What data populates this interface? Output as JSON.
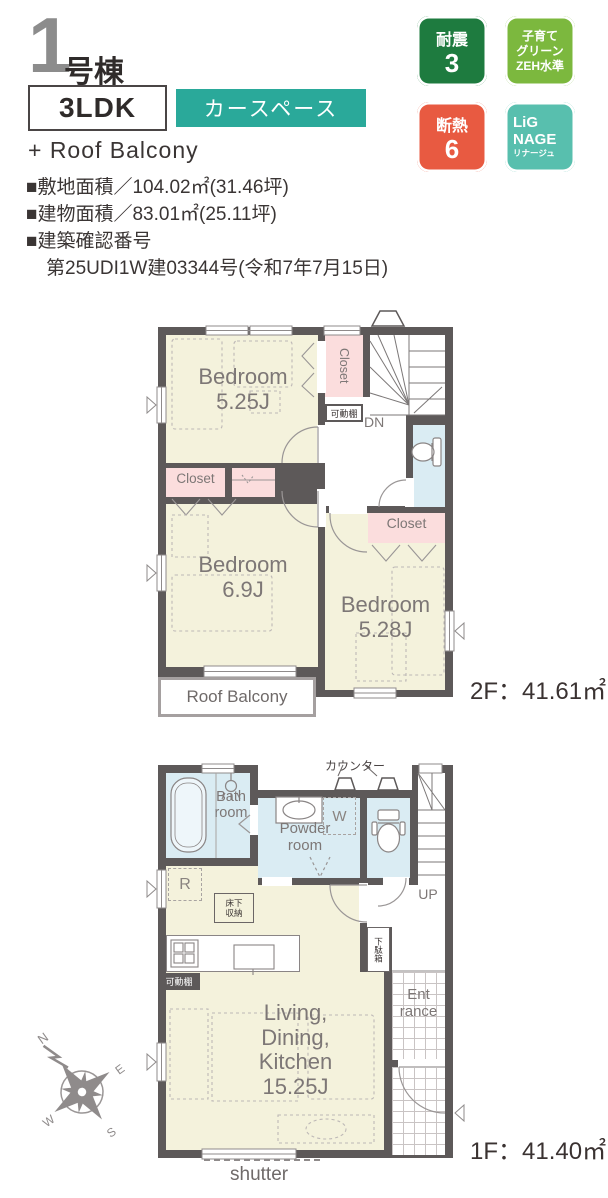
{
  "header": {
    "unit_number": "1",
    "unit_suffix": "号棟",
    "layout": "3LDK",
    "feature": "カースペース",
    "extra": "+ Roof Balcony"
  },
  "specs": {
    "site_area": "■敷地面積／104.02㎡(31.46坪)",
    "building_area": "■建物面積／83.01㎡(25.11坪)",
    "confirmation_title": "■建築確認番号",
    "confirmation_number": "第25UDI1W建03344号(令和7年7月15日)"
  },
  "badges": {
    "taishin_label": "耐震",
    "taishin_value": "3",
    "kosodate_lines": "子育て\nグリーン\nZEH水準",
    "dannetsu_label": "断熱",
    "dannetsu_value": "6",
    "lignage_line1": "LiG",
    "lignage_line2": "NAGE",
    "lignage_line3": "リナージュ"
  },
  "colors": {
    "taishin": "#1e7b3f",
    "kosodate": "#7cb83e",
    "dannetsu": "#e85a41",
    "lignage": "#58bfae",
    "feature_badge": "#2aa99a"
  },
  "floor2": {
    "area_label": "2F：41.61㎡",
    "bedroom1": "Bedroom\n5.25J",
    "closet_top": "Closet",
    "kadoudana": "可動棚",
    "dn": "DN",
    "closet_mid": "Closet",
    "bedroom2": "Bedroom\n6.9J",
    "bedroom3": "Bedroom\n5.28J",
    "closet3": "Closet",
    "roof_balcony": "Roof Balcony"
  },
  "floor1": {
    "area_label": "1F：41.40㎡",
    "bath": "Bath\nroom",
    "powder": "Powder\nroom",
    "counter": "カウンター",
    "washer": "W",
    "up": "UP",
    "fridge": "R",
    "floor_storage": "床下\n収納",
    "kadoudana": "可動棚",
    "shoe_box": "下駄箱",
    "entrance": "Ent\nrance",
    "ldk": "Living,\nDining,\nKitchen\n15.25J",
    "shutter": "shutter"
  },
  "compass": {
    "n": "N",
    "e": "E",
    "s": "S",
    "w": "W"
  }
}
